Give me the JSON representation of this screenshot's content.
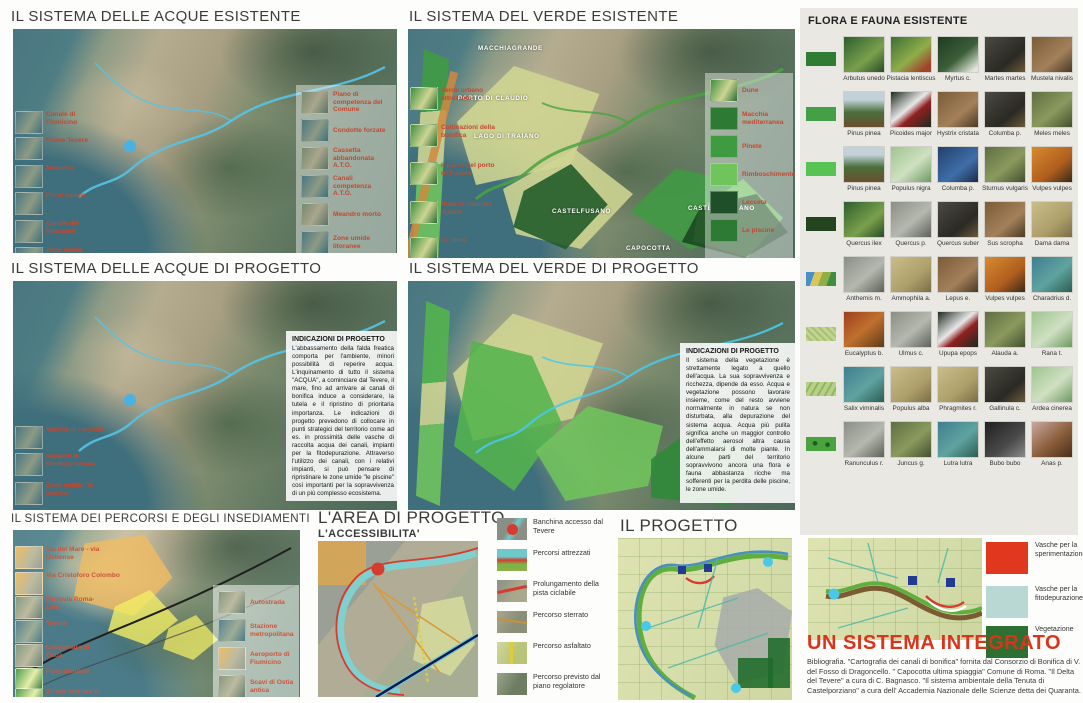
{
  "acqueEx": {
    "title": "IL SISTEMA DELLE ACQUE ESISTENTE",
    "left_labels": [
      "Canale di Fiumicino",
      "Fiume Tevere",
      "Meandro",
      "Porto canale",
      "Canale dei Pescatori",
      "Zone umide"
    ],
    "legend": [
      "Piano di competenza del Comune",
      "Condotte forzate",
      "Cassetta abbandonata A.T.O.",
      "Canali competenza A.T.O.",
      "Meandro morto",
      "Zone umide litoranee"
    ]
  },
  "verdeEx": {
    "title": "IL SISTEMA DEL VERDE ESISTENTE",
    "places": [
      "MACCHIAGRANDE",
      "PORTO DI CLAUDIO",
      "LAGO DI TRAIANO",
      "CASTELFUSANO",
      "CASTELPORZIANO",
      "CAPOCOTTA"
    ],
    "left_labels": [
      "Verde urbano attrezzato",
      "Coltivazioni della bonifica",
      "Il parco del porto di Traiano",
      "Riserva naturale statale",
      "Le dune"
    ],
    "legend": [
      "Dune",
      "Macchia mediterranea",
      "Pinete",
      "Rimboschimento",
      "Lecceta",
      "Le piscine"
    ]
  },
  "flora": {
    "title": "FLORA E FAUNA ESISTENTE",
    "rows": [
      {
        "swatch": "#2e7d32",
        "species": [
          "Arbutus unedo",
          "Pistacia lentiscus",
          "Myrtus c.",
          "Martes martes",
          "Mustela nivalis"
        ]
      },
      {
        "swatch": "#43a047",
        "species": [
          "Pinus pinea",
          "Picoides major",
          "Hystrix cristata",
          "Columba p.",
          "Meles meles"
        ]
      },
      {
        "swatch": "#58c252",
        "species": [
          "Pinus pinea",
          "Populus nigra",
          "Columba p.",
          "Sturnus vulgaris",
          "Vulpes vulpes"
        ]
      },
      {
        "swatch": "#23441f",
        "species": [
          "Quercus ilex",
          "Quercus p.",
          "Quercus suber",
          "Sus scropha",
          "Dama dama"
        ]
      },
      {
        "swatch": "linear-gradient(110deg,#4a90c8 0 25%,#d8c55e 25% 48%,#8fae4a 48% 72%,#3f8f3f 72% 100%)",
        "species": [
          "Anthemis m.",
          "Ammophila a.",
          "Lepus e.",
          "Vulpes vulpes",
          "Charadrius d."
        ]
      },
      {
        "swatch": "repeating-linear-gradient(45deg,#c2d494 0 3px,#a8c070 3px 5px)",
        "species": [
          "Eucalyptus b.",
          "Ulmus c.",
          "Upupa epops",
          "Alauda a.",
          "Rana t."
        ]
      },
      {
        "swatch": "repeating-linear-gradient(120deg,#b8cf8a 0 4px,#8fb85e 4px 6px)",
        "species": [
          "Salix viminalis",
          "Populus alba",
          "Phragmites r.",
          "Gallinula c.",
          "Ardea cinerea"
        ]
      },
      {
        "swatch": "radial-gradient(circle at 30% 45%, #1f5c22 2px, transparent 2.6px), radial-gradient(circle at 72% 55%, #1f5c22 2px, transparent 2.6px), #49a33f",
        "species": [
          "Ranunculus r.",
          "Juncus g.",
          "Lutra lutra",
          "Bubo bubo",
          "Anas p."
        ]
      }
    ]
  },
  "acquePr": {
    "title": "IL SISTEMA DELLE ACQUE DI PROGETTO",
    "left_labels": [
      "Vasche di raccolta",
      "Impianti di fitodepurazione",
      "Zone umide \"le piscine\""
    ],
    "ind_title": "INDICAZIONI DI PROGETTO",
    "ind_text": "L'abbassamento della falda freatica comporta per l'ambiente, minori possibilità di reperire acqua. L'inquinamento di tutto il sistema \"ACQUA\", a cominciare dal Tevere, il mare, fino ad arrivare ai canali di bonifica induce a considerare, la tutela e il ripristino di prioritaria importanza. Le indicazioni di progetto prevedono di collocare in punti strategici del territorio come ad es. in prossimità delle vasche di raccolta acqua dei canali, impianti per la fitodepurazione. Attraverso l'utilizzo dei canali, con i relativi impianti, si può pensare di ripristinare le zone umide \"le piscine\" così importanti per la sopravvivenza di un più complesso ecosistema."
  },
  "verdePr": {
    "title": "IL SISTEMA DEL VERDE DI PROGETTO",
    "ind_title": "INDICAZIONI DI PROGETTO",
    "ind_text": "Il sistema della vegetazione è strettamente legato a quello dell'acqua. La sua sopravvivenza e ricchezza, dipende da esso. Acqua e vegetazione possono lavorare insieme, come del resto avviene normalmente in natura se non disturbata, alla depurazione del sistema acqua. Acqua più pulita significa anche un maggior controllo dell'effetto aerosol altra causa dell'ammalarsi di molte piante. In alcune parti del territorio sopravvivono ancora una flora e fauna abbastanza ricche ma sofferenti per la perdita delle piscine, le zone umide."
  },
  "percorsi": {
    "title": "IL SISTEMA DEI PERCORSI E DEGLI INSEDIAMENTI",
    "left_labels": [
      "Via del Mare - via Ostiense",
      "Via Cristoforo Colombo",
      "Ferrovia Roma-Lido",
      "Tevere",
      "Lungomare di Ostia",
      "Pista ciclabile",
      "Strade sterrate di bonifica"
    ],
    "legend": [
      "Autostrada",
      "Stazione metropolitana",
      "Aeroporto di Fiumicino",
      "Scavi di Ostia antica",
      "Insediamenti abusivi"
    ]
  },
  "accesso": {
    "title": "L'AREA DI PROGETTO",
    "subtitle": "L'ACCESSIBILITA'",
    "legend": [
      "Banchina accesso dal Tevere",
      "Percorsi attrezzati",
      "Prolungamento della pista ciclabile",
      "Percorso sterrato",
      "Percorso asfaltato",
      "Percorso previsto dal piano regolatore"
    ]
  },
  "progetto": {
    "title": "IL PROGETTO"
  },
  "integrato": {
    "title": "UN SISTEMA INTEGRATO",
    "legend": [
      {
        "label": "Vasche per la sperimentazione",
        "color": "#e0371e"
      },
      {
        "label": "Vasche per la fitodepurazione",
        "color": "#b9d8d4"
      },
      {
        "label": "Vegetazione",
        "color": "#2e7031"
      }
    ],
    "bibliography": "Bibliografia. \"Cartografia dei canali di bonifica\" fornita dal Consorzio di Bonifica di V. del Fosso di Dragoncello.  \" Capocotta ultima spiaggia\" Comune di Roma. \"Il Delta del Tevere\" a cura di C. Bagnasco.   \"Il sistema ambientale della Tenuta di Castelporziano\" a cura dell' Accademia Nazionale delle Scienze detta dei Quaranta."
  }
}
